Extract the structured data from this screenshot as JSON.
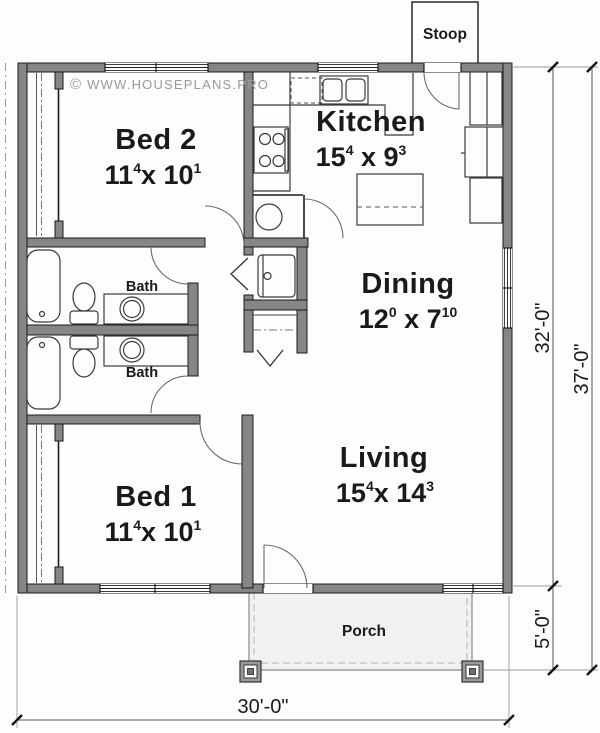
{
  "watermark": {
    "symbol": "©",
    "text": "WWW.HOUSEPLANS.PRO"
  },
  "rooms": {
    "bed2": {
      "label": "Bed 2",
      "dim": {
        "a": "11",
        "asup": "4",
        "b": "x 10",
        "bsup": "1"
      }
    },
    "kitchen": {
      "label": "Kitchen",
      "dim": {
        "a": "15",
        "asup": "4",
        "b": " x 9",
        "bsup": "3"
      }
    },
    "dining": {
      "label": "Dining",
      "dim": {
        "a": "12",
        "asup": "0",
        "b": " x 7",
        "bsup": "10"
      }
    },
    "living": {
      "label": "Living",
      "dim": {
        "a": "15",
        "asup": "4",
        "b": "x 14",
        "bsup": "3"
      }
    },
    "bed1": {
      "label": "Bed 1",
      "dim": {
        "a": "11",
        "asup": "4",
        "b": "x 10",
        "bsup": "1"
      }
    },
    "bath1": {
      "label": "Bath"
    },
    "bath2": {
      "label": "Bath"
    },
    "stoop": {
      "label": "Stoop"
    },
    "porch": {
      "label": "Porch"
    }
  },
  "dimensions": {
    "right_inner": "32'-0\"",
    "right_outer": "37'-0\"",
    "porch_depth": "5'-0\"",
    "bottom_width": "30'-0\""
  },
  "colors": {
    "wall": "#868686",
    "wall_outline": "#1a1a1a",
    "porch_fill": "#f1f1f1",
    "watermark": "#9a9a9a",
    "text": "#1a1a1a"
  }
}
